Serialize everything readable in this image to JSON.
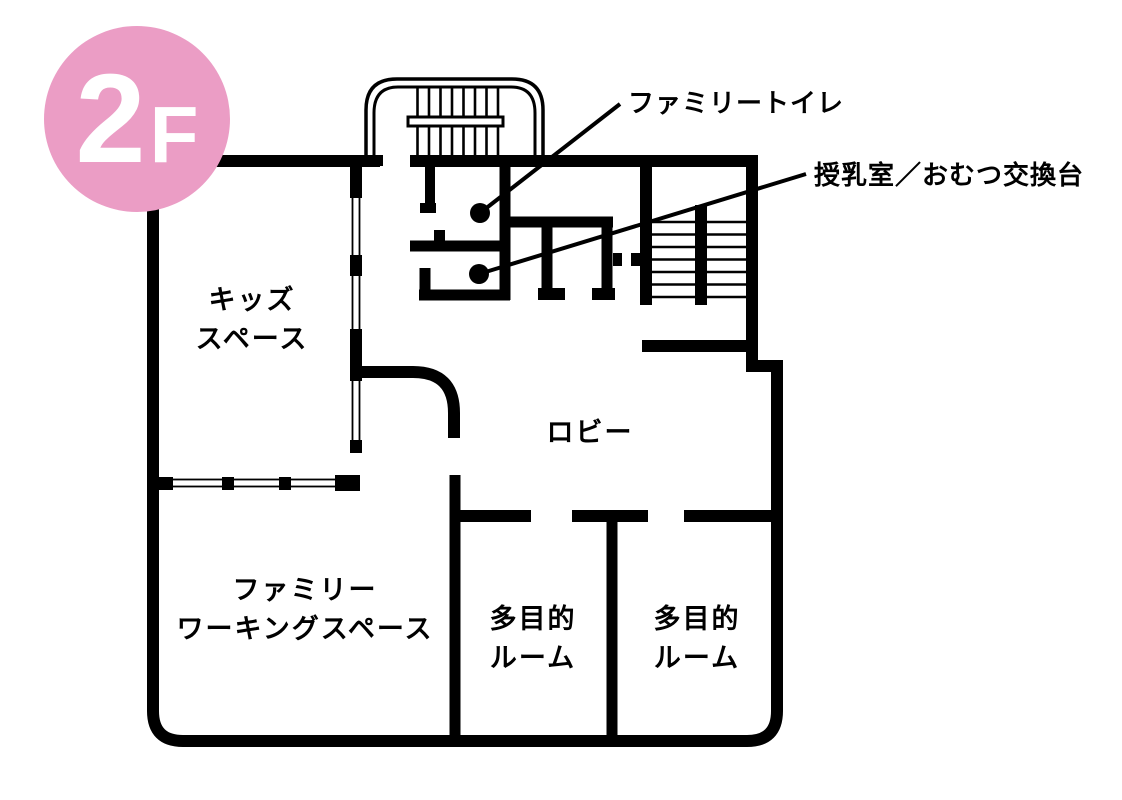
{
  "badge": {
    "floor_number": "2",
    "floor_suffix": "F"
  },
  "colors": {
    "badge_pink": "#eb9dc5",
    "wall_black": "#000000",
    "text_black": "#000000"
  },
  "rooms": {
    "kids_space": {
      "line1": "キッズ",
      "line2": "スペース"
    },
    "lobby": {
      "line1": "ロビー"
    },
    "family_working_space": {
      "line1": "ファミリー",
      "line2": "ワーキングスペース"
    },
    "multipurpose_room_1": {
      "line1": "多目的",
      "line2": "ルーム"
    },
    "multipurpose_room_2": {
      "line1": "多目的",
      "line2": "ルーム"
    }
  },
  "callouts": {
    "family_toilet": {
      "label": "ファミリートイレ"
    },
    "nursing_room": {
      "label": "授乳室／おむつ交換台"
    }
  }
}
